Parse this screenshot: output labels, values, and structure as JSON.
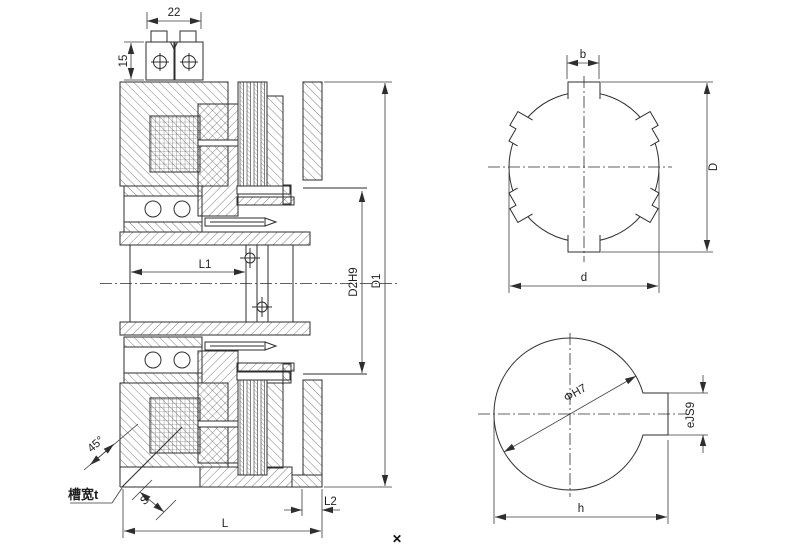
{
  "section_view": {
    "dims": {
      "terminal_width": "22",
      "terminal_height": "15",
      "bore_length": "L1",
      "flange_bore_dia": "D2H9",
      "outer_dia": "D1",
      "overall_length": "L",
      "flange_protrusion": "L2",
      "groove_angle": "45°",
      "groove_depth": "S"
    },
    "notes": {
      "groove_width": "槽宽t"
    }
  },
  "spline_view": {
    "dims": {
      "tab_width": "b",
      "tip_dia": "D",
      "root_dia": "d"
    }
  },
  "keyway_view": {
    "dims": {
      "bore_dia": "ΦH7",
      "key_width": "eJS9",
      "bore_key_height": "h"
    }
  },
  "overlay": {
    "marker": "✕"
  },
  "colors": {
    "outline": "#2e2e2e",
    "hatch": "#555555",
    "dimension": "#3a3a3a",
    "text": "#1f1f1f",
    "background": "#ffffff"
  }
}
